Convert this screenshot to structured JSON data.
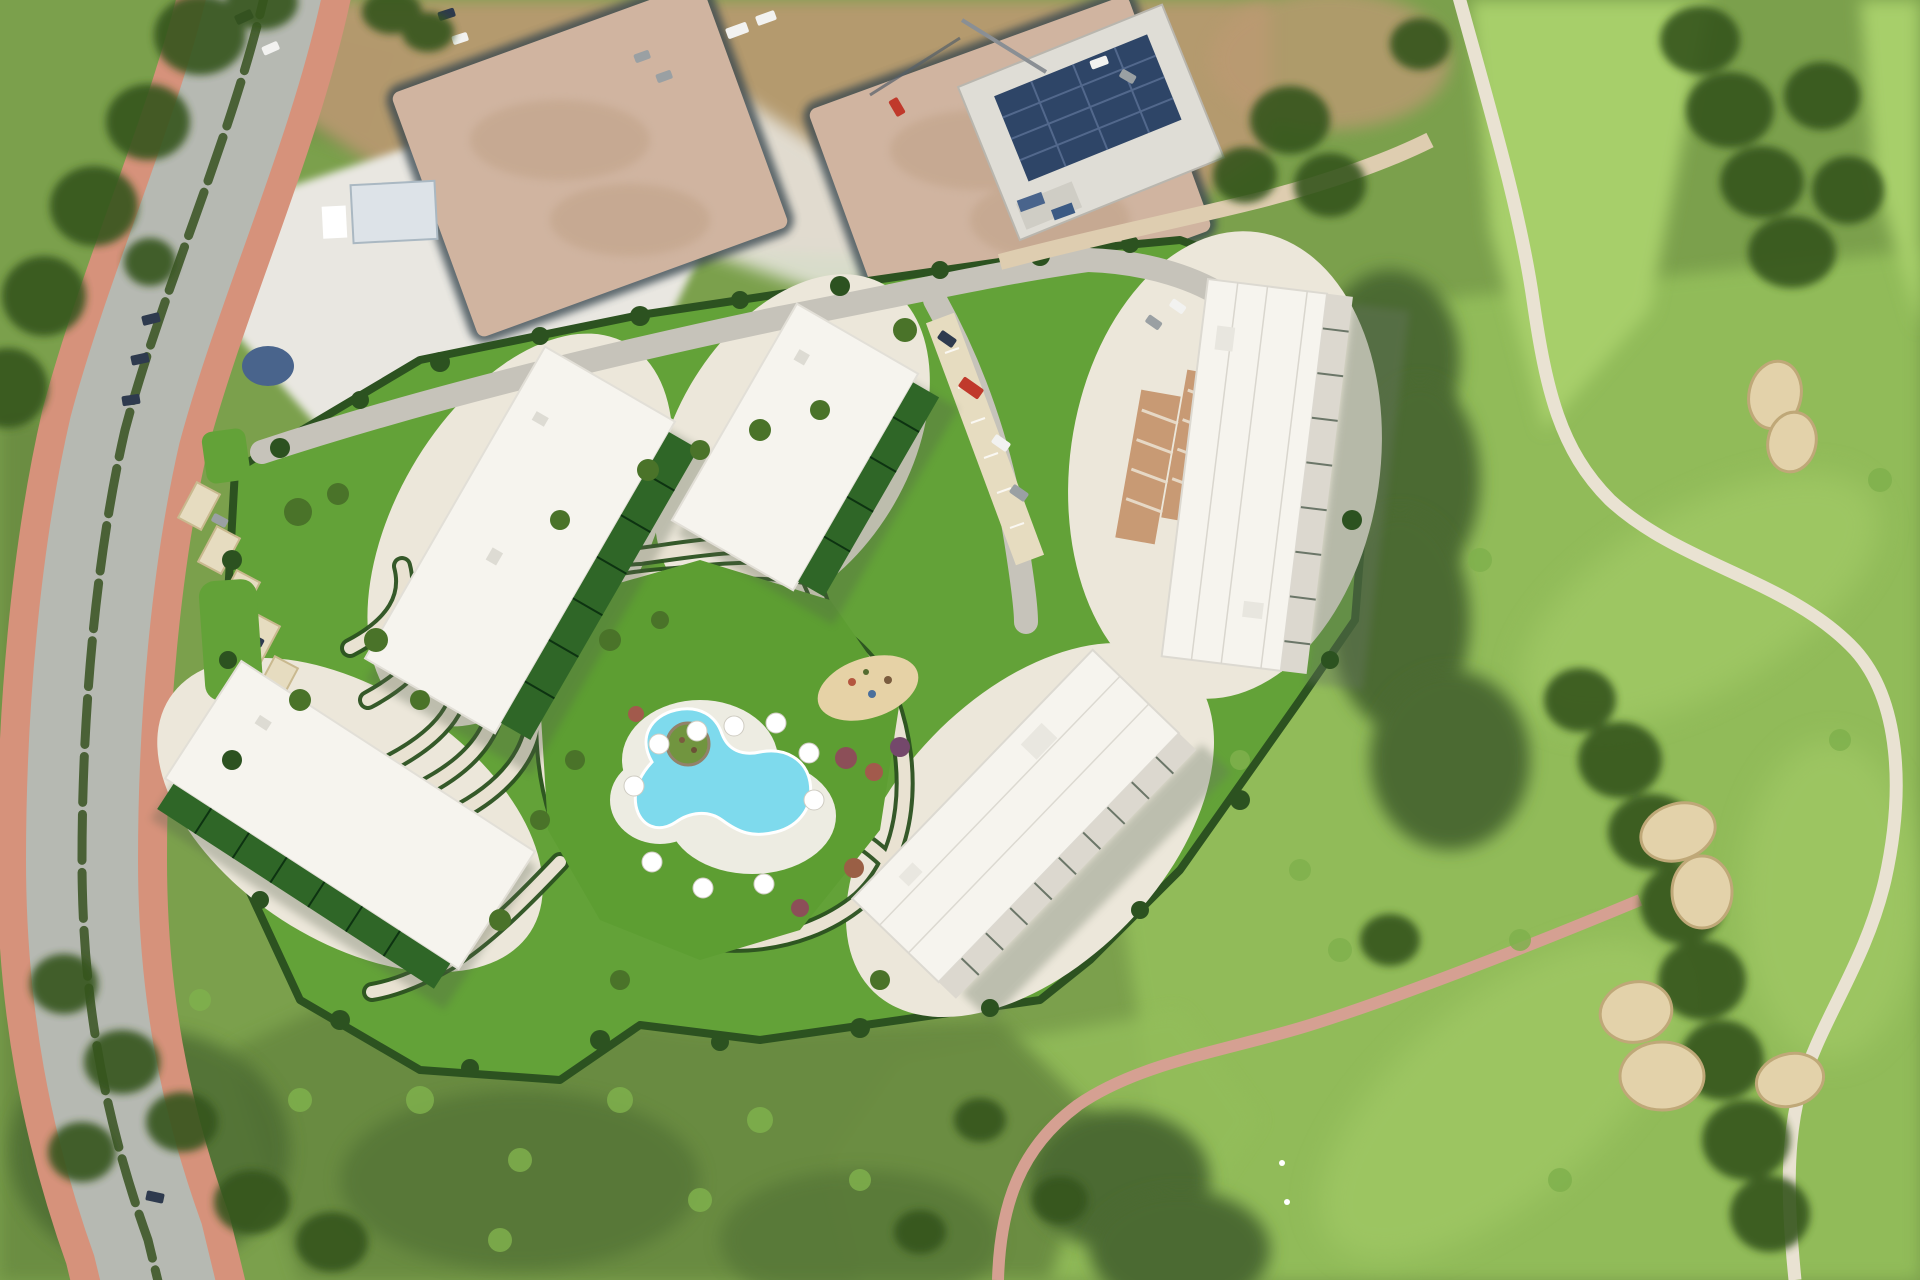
{
  "scene": {
    "type": "aerial-photograph",
    "description": "Aerial view of a residential development render: five white flat-roofed apartment blocks around a landscaped garden with a free-form turquoise pool and white parasols; a curving dual-carriageway avenue with red sidewalks to the west; construction plots and a solar-roofed building under construction to the north; a golf course with fairways, tree belts, sand bunkers and a winding cart path to the east; a pink footpath crossing the meadow to the south-east.",
    "counts": {
      "apartment_blocks": 5,
      "sand_bunkers": 4,
      "pool_umbrellas": 10,
      "construction_plots": 2
    },
    "features": [
      "dual-carriageway-avenue",
      "red-sidewalks",
      "median-hedge",
      "parked-cars",
      "staging-area",
      "construction-plots",
      "solar-roof-building",
      "tower-crane",
      "site-hedge-boundary",
      "apartment-blocks",
      "private-terraces",
      "landscaped-garden",
      "terraced-paths",
      "swimming-pool",
      "pool-island",
      "pool-umbrellas",
      "flower-shrubs",
      "playground",
      "carports",
      "parking-rows",
      "golf-fairways",
      "tree-belts",
      "sand-bunkers",
      "cart-path",
      "pink-footpath"
    ]
  },
  "palette": {
    "grass_base": "#7ba04c",
    "scrub_olive": "#68893f",
    "scrub_dark": "#4c6b33",
    "tree_dark": "#35551f",
    "tree_mid": "#4a7329",
    "tree_light": "#7fb04c",
    "fairway": "#93bd5a",
    "fairway_light": "#a7cf6b",
    "lawn_render": "#63a238",
    "lawn_bright": "#5d9e32",
    "hedge_dark": "#2c5220",
    "path_cream": "#e9e2d2",
    "sand_beige": "#ece7da",
    "road_asphalt": "#b6b9b2",
    "inner_road": "#c6c3ba",
    "sidewalk_red": "#d6927b",
    "median_green": "#4a6136",
    "white_area": "#e9e7e1",
    "dirt_brown": "#bb9a72",
    "dirt_plot": "#d0b4a0",
    "trench_dark": "#37474f",
    "solar_navy": "#2e4567",
    "building_white": "#f6f4ee",
    "building_shade": "#dcd8cf",
    "terrace_green": "#2f6627",
    "shadow_green": "#66745e",
    "pool_water": "#7edaed",
    "pool_deck": "#edece2",
    "umbrella_white": "#ffffff",
    "bunker_sand": "#e3d2aa",
    "bunker_edge": "#bfa878",
    "pink_path": "#d5a092",
    "car_dark": "#2e3a4e",
    "car_white": "#f2f2f0",
    "car_red": "#c0392b",
    "car_gray": "#9aa0a3",
    "canopy_cream": "#e6dcc0",
    "canopy_terracotta": "#c89a74",
    "tarp_blue": "#49648c",
    "concrete": "#dfddd6"
  }
}
